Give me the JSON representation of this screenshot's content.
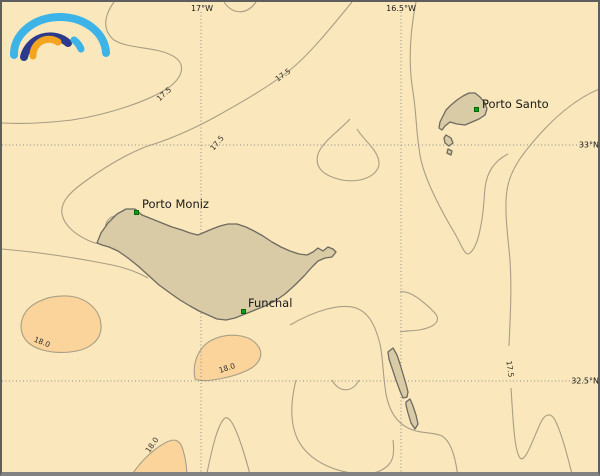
{
  "map": {
    "description": "Sea surface isotherm map of the Madeira archipelago",
    "colors": {
      "background": "#FAE7BB",
      "frame": "#5E5E5E",
      "warm_region_fill": "#FBD49C",
      "island_fill": "#D8CBA6",
      "island_outline": "#6E6A60",
      "contour_line": "#A89E85",
      "grid_line": "#8F8F8F",
      "marker": "#0FA00F",
      "label": "#1A1A1A"
    }
  },
  "logo": {
    "name": "rainbow-arcs-logo",
    "arc_colors": {
      "outer": "#3DB4E8",
      "middle": "#2B3A8C",
      "inner": "#F4A41E",
      "stub": "#3DB4E8"
    }
  },
  "grid": {
    "labels": [
      {
        "text": "17°W",
        "x": 200,
        "y": 2,
        "align": "top"
      },
      {
        "text": "16.5°W",
        "x": 399,
        "y": 2,
        "align": "top"
      },
      {
        "text": "33°N",
        "x": 597,
        "y": 143,
        "align": "right"
      },
      {
        "text": "32.5°N",
        "x": 597,
        "y": 379,
        "align": "right"
      }
    ]
  },
  "places": [
    {
      "name": "Porto Moniz",
      "marker_x": 134,
      "marker_y": 210,
      "label_dx": 6,
      "label_dy": -15
    },
    {
      "name": "Funchal",
      "marker_x": 241,
      "marker_y": 309,
      "label_dx": 5,
      "label_dy": -15
    },
    {
      "name": "Porto Santo",
      "marker_x": 474,
      "marker_y": 107,
      "label_dx": 6,
      "label_dy": -12
    }
  ],
  "isotherm_labels": [
    {
      "value": "17.5",
      "x": 162,
      "y": 92,
      "rotation": -42
    },
    {
      "value": "17.5",
      "x": 281,
      "y": 73,
      "rotation": -35
    },
    {
      "value": "17.5",
      "x": 215,
      "y": 141,
      "rotation": -50
    },
    {
      "value": "17.5",
      "x": 508,
      "y": 367,
      "rotation": 82
    },
    {
      "value": "18.0",
      "x": 40,
      "y": 340,
      "rotation": 22
    },
    {
      "value": "18.0",
      "x": 225,
      "y": 366,
      "rotation": -18
    },
    {
      "value": "18.0",
      "x": 150,
      "y": 443,
      "rotation": -55
    }
  ]
}
